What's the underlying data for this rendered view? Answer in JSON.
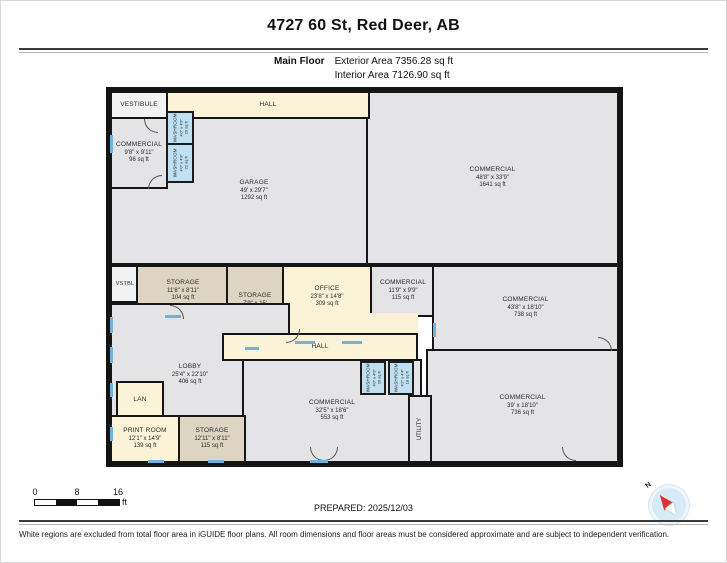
{
  "header": {
    "title": "4727 60 St, Red Deer, AB",
    "floor_label": "Main Floor",
    "exterior_area": "Exterior Area 7356.28 sq ft",
    "interior_area": "Interior Area 7126.90 sq ft"
  },
  "rooms": {
    "vestibule": {
      "label": "VESTIBULE"
    },
    "hall_top": {
      "label": "HALL"
    },
    "commercial_96": {
      "label": "COMMERCIAL",
      "dims": "9'8\" x 9'11\"",
      "area": "96 sq ft"
    },
    "washroom_23": {
      "label": "WASHROOM",
      "dims": "4'0\" x 4'9\"",
      "area": "23 sq ft"
    },
    "washroom_22": {
      "label": "WASHROOM",
      "dims": "4'0\" x 4'9\"",
      "area": "22 sq ft"
    },
    "garage": {
      "label": "GARAGE",
      "dims": "49' x 29'7\"",
      "area": "1292 sq ft"
    },
    "commercial_1641": {
      "label": "COMMERCIAL",
      "dims": "48'8\" x 33'9\"",
      "area": "1641 sq ft"
    },
    "vstbl": {
      "label": "VSTBL"
    },
    "storage_104": {
      "label": "STORAGE",
      "dims": "11'8\" x 8'11\"",
      "area": "104 sq ft"
    },
    "storage_116": {
      "label": "STORAGE",
      "dims": "7'9\" x 15'",
      "area": "116 sq ft"
    },
    "office": {
      "label": "OFFICE",
      "dims": "23'8\" x 14'8\"",
      "area": "309 sq ft"
    },
    "commercial_115": {
      "label": "COMMERCIAL",
      "dims": "11'9\" x 9'9\"",
      "area": "115 sq ft"
    },
    "commercial_738": {
      "label": "COMMERCIAL",
      "dims": "43'8\" x 18'10\"",
      "area": "738 sq ft"
    },
    "hall_mid": {
      "label": "HALL"
    },
    "lobby": {
      "label": "LOBBY",
      "dims": "25'4\" x 22'10\"",
      "area": "406 sq ft"
    },
    "lan": {
      "label": "LAN"
    },
    "print_room": {
      "label": "PRINT ROOM",
      "dims": "12'1\" x 14'9\"",
      "area": "139 sq ft"
    },
    "storage_115": {
      "label": "STORAGE",
      "dims": "12'11\" x 8'11\"",
      "area": "115 sq ft"
    },
    "commercial_553": {
      "label": "COMMERCIAL",
      "dims": "32'5\" x 18'6\"",
      "area": "553 sq ft"
    },
    "washroom_20": {
      "label": "WASHROOM",
      "dims": "4'0\" x 4'9\"",
      "area": "20 sq ft"
    },
    "washroom_18": {
      "label": "WASHROOM",
      "dims": "4'2\" x 4'4\"",
      "area": "18 sq ft"
    },
    "utility": {
      "label": "UTILITY"
    },
    "commercial_736": {
      "label": "COMMERCIAL",
      "dims": "39' x 18'10\"",
      "area": "736 sq ft"
    }
  },
  "footer": {
    "scale": {
      "ticks": [
        "0",
        "8",
        "16"
      ],
      "unit": "ft"
    },
    "prepared": "PREPARED: 2025/12/03",
    "compass_n": "N",
    "disclaimer": "White regions are excluded from total floor area in iGUIDE floor plans. All room dimensions and floor areas must be considered approximate and are subject to independent verification."
  },
  "colors": {
    "wall": "#141414",
    "room_gray": "#e4e4e6",
    "room_cream": "#fbf3d7",
    "room_tan": "#ddd4c1",
    "room_washroom_blue": "#bfe0f2",
    "window_blue": "#6fb3dc",
    "compass_red": "#e03131",
    "compass_blue": "#d7eaf7"
  }
}
